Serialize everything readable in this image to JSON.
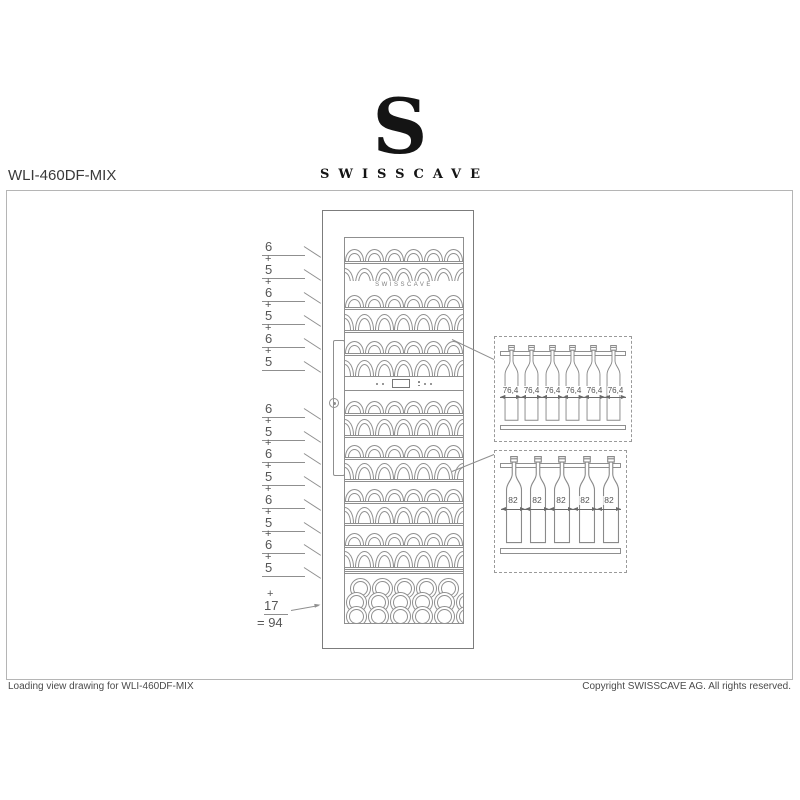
{
  "page": {
    "title": "WLI-460DF-MIX",
    "footer": {
      "left": "Loading view drawing for WLI-460DF-MIX",
      "right": "Copyright SWISSCAVE AG. All rights reserved."
    }
  },
  "logo": {
    "monogram": "S",
    "wordmark": "SWISSCAVE"
  },
  "cabinet": {
    "door_brand": "SWISSCAVE",
    "upper_zone_bottle_counts": [
      6,
      5,
      6,
      5,
      6,
      5
    ],
    "lower_zone_bottle_counts": [
      6,
      5,
      6,
      5,
      6,
      5,
      6,
      5
    ],
    "bottom_stack_rows": [
      5,
      6,
      6
    ]
  },
  "dimension_labels": {
    "plus_sign": "+",
    "upper": [
      "6",
      "5",
      "6",
      "5",
      "6",
      "5"
    ],
    "lower": [
      "6",
      "5",
      "6",
      "5",
      "6",
      "5",
      "6",
      "5"
    ],
    "sum": {
      "value": "17",
      "total": "= 94"
    }
  },
  "callouts": [
    {
      "name": "upper-shelf-detail",
      "bottles": 6,
      "dim_label": "76,4"
    },
    {
      "name": "lower-shelf-detail",
      "bottles": 5,
      "dim_label": "82"
    }
  ],
  "colors": {
    "line": "#8f8f8f",
    "text": "#565656",
    "ink": "#141414"
  }
}
